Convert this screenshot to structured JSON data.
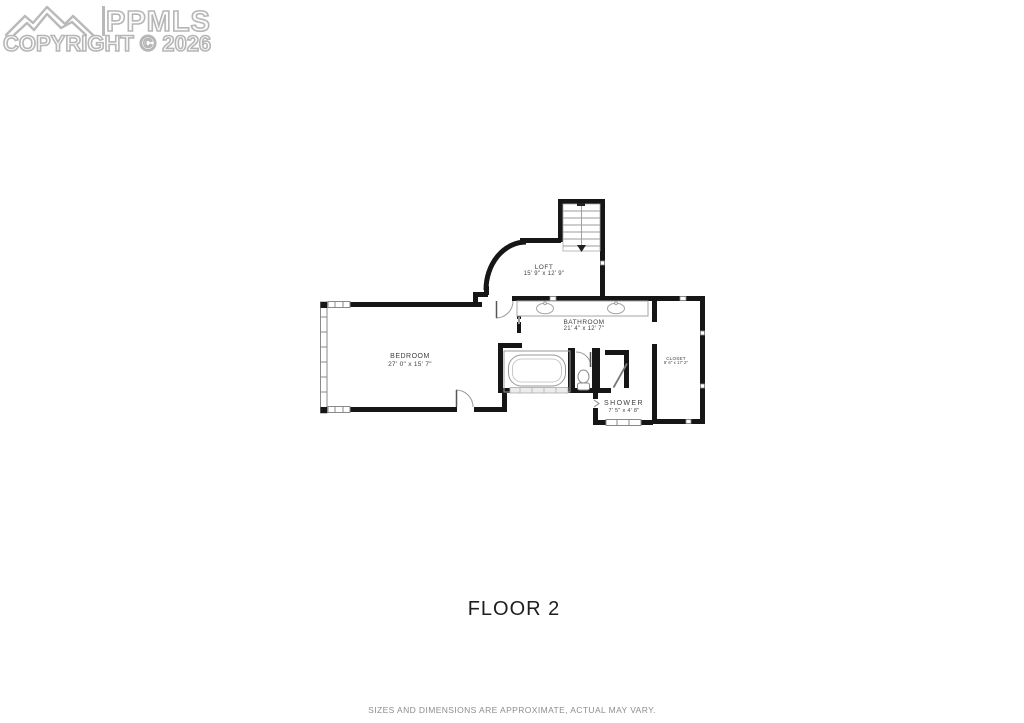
{
  "watermark": {
    "brand": "PPMLS",
    "copyright": "COPYRIGHT © 2026"
  },
  "title": "FLOOR 2",
  "disclaimer": "SIZES AND DIMENSIONS ARE APPROXIMATE, ACTUAL MAY VARY.",
  "floor_plan": {
    "rooms": [
      {
        "id": "loft",
        "name": "LOFT",
        "dimensions": "15' 9\" x 12' 9\""
      },
      {
        "id": "bathroom",
        "name": "BATHROOM",
        "dimensions": "21' 4\" x 12' 7\""
      },
      {
        "id": "bedroom",
        "name": "BEDROOM",
        "dimensions": "27' 0\" x 15' 7\""
      },
      {
        "id": "closet",
        "name": "CLOSET",
        "dimensions": "6' 6\" x 17' 2\""
      },
      {
        "id": "shower",
        "name": "SHOWER",
        "dimensions": "7' 5\" x 4' 8\""
      }
    ],
    "fixtures": [
      "staircase",
      "bathtub",
      "double-sink-vanity",
      "toilet",
      "shower-door"
    ]
  },
  "colors": {
    "wall": "#161616",
    "fixture_outline": "#999999",
    "watermark_gray": "#b6b6b6",
    "label_text": "#3f3f3f"
  }
}
